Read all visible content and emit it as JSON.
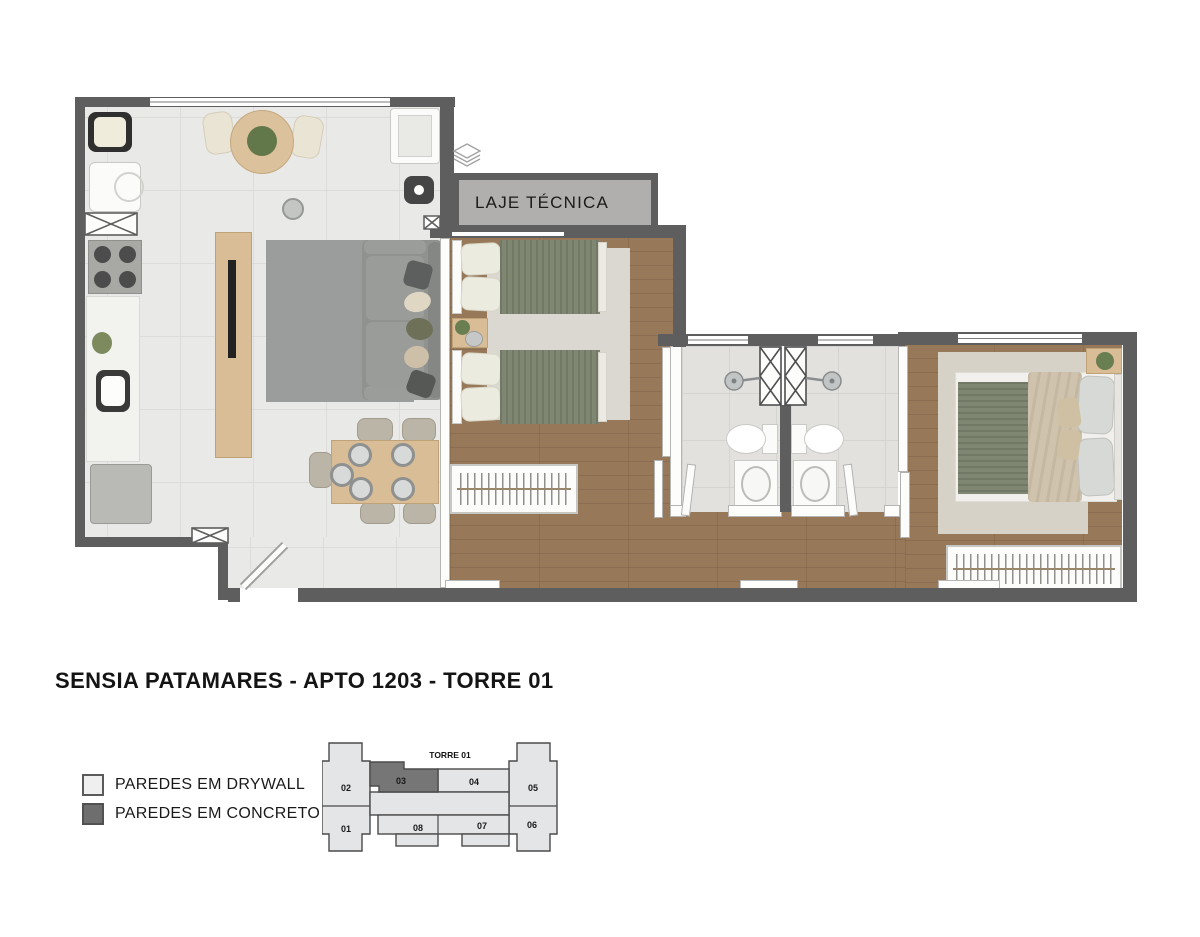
{
  "title": "SENSIA PATAMARES -  APTO 1203 - TORRE 01",
  "floorplan": {
    "laje_label": "LAJE TÉCNICA",
    "colors": {
      "concrete_wall": "#5e5e5e",
      "drywall": "#fdfdfc",
      "tile_floor": "#e9e9e7",
      "wood_floor": "#97795a",
      "bath_floor": "#e2e1de",
      "laje_fill": "#b0afad"
    }
  },
  "legend": {
    "items": [
      {
        "label": "PAREDES EM DRYWALL",
        "color": "#efefef"
      },
      {
        "label": "PAREDES EM CONCRETO",
        "color": "#6e6e6e"
      }
    ]
  },
  "keyplan": {
    "tower_label": "TORRE 01",
    "highlighted_unit": "03",
    "highlight_color": "#767676",
    "base_color": "#e4e5e7",
    "units": [
      {
        "number": "02"
      },
      {
        "number": "03"
      },
      {
        "number": "04"
      },
      {
        "number": "05"
      },
      {
        "number": "01"
      },
      {
        "number": "08"
      },
      {
        "number": "07"
      },
      {
        "number": "06"
      }
    ]
  },
  "logo": {
    "icon": "layered-diamond-icon"
  }
}
